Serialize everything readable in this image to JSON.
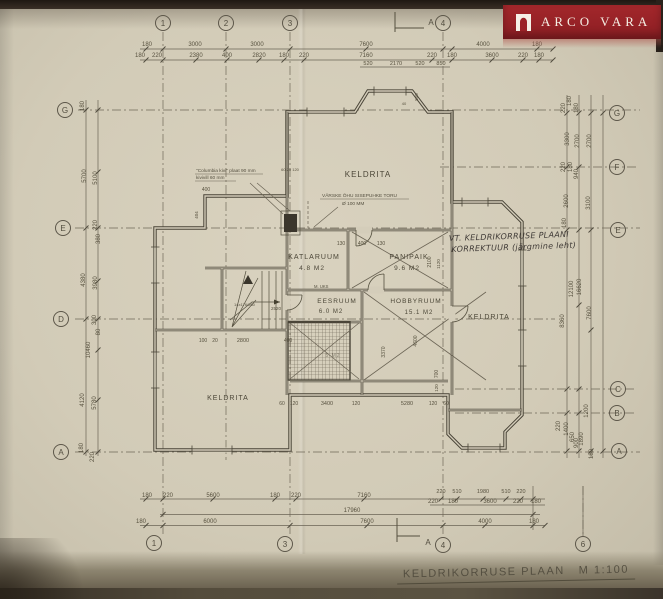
{
  "logo": {
    "brand": "ARCO VARA",
    "bg": "#9b2227"
  },
  "title": {
    "name": "KELDRIKORRUSE  PLAAN",
    "scale": "M 1:100"
  },
  "section_marker": "A",
  "grid": {
    "top": [
      "1",
      "2",
      "3",
      "4"
    ],
    "bottom": [
      "1",
      "3",
      "4",
      "6"
    ],
    "left": [
      "G",
      "E",
      "D",
      "A"
    ],
    "right": [
      "G",
      "F",
      "E",
      "C",
      "B",
      "A"
    ]
  },
  "rooms": {
    "keldrita_top": {
      "name": "KELDRITA"
    },
    "katlaruum": {
      "name": "KATLARUUM",
      "area": "4.8 M2"
    },
    "panipaik": {
      "name": "PANIPAIK",
      "area": "9.6 M2"
    },
    "eesruum": {
      "name": "EESRUUM",
      "area": "6.0 M2"
    },
    "hobbyruum": {
      "name": "HOBBYRUUM",
      "area": "15.1 M2"
    },
    "keldrita_right": {
      "name": "KELDRITA"
    },
    "keldrita_left": {
      "name": "KELDRITA"
    },
    "shaft": {
      "area": "5 M2"
    }
  },
  "notes": {
    "insulation_1": "\"Columbia kivi\" plaat 90 mm",
    "insulation_2": "kivivill 60 mm",
    "vent_1": "VÄRSKE ÕHU SISEPUHKE TORU",
    "vent_2": "Ø 100 MM",
    "door_label": "M. UKS",
    "stair_label": "14x176/260",
    "hand_1": "VT. KELDRIKORRUSE PLAANI",
    "hand_2": "KORREKTUUR (järgmine leht)"
  },
  "dim_labels": [
    {
      "x": 147,
      "y": 46,
      "t": "180"
    },
    {
      "x": 195,
      "y": 46,
      "t": "3000"
    },
    {
      "x": 257,
      "y": 46,
      "t": "3000"
    },
    {
      "x": 366,
      "y": 46,
      "t": "7600"
    },
    {
      "x": 483,
      "y": 46,
      "t": "4000"
    },
    {
      "x": 537,
      "y": 46,
      "t": "180"
    },
    {
      "x": 140,
      "y": 57,
      "t": "180"
    },
    {
      "x": 157,
      "y": 57,
      "t": "220"
    },
    {
      "x": 196,
      "y": 57,
      "t": "2380"
    },
    {
      "x": 227,
      "y": 57,
      "t": "400"
    },
    {
      "x": 259,
      "y": 57,
      "t": "2820"
    },
    {
      "x": 284,
      "y": 57,
      "t": "180"
    },
    {
      "x": 304,
      "y": 57,
      "t": "220"
    },
    {
      "x": 366,
      "y": 57,
      "t": "7160"
    },
    {
      "x": 432,
      "y": 57,
      "t": "220"
    },
    {
      "x": 452,
      "y": 57,
      "t": "180"
    },
    {
      "x": 492,
      "y": 57,
      "t": "3600"
    },
    {
      "x": 523,
      "y": 57,
      "t": "220"
    },
    {
      "x": 539,
      "y": 57,
      "t": "180"
    },
    {
      "x": 368,
      "y": 65,
      "t": "520",
      "s": 5.5
    },
    {
      "x": 396,
      "y": 65,
      "t": "2170",
      "s": 5.5
    },
    {
      "x": 420,
      "y": 65,
      "t": "520",
      "s": 5.5
    },
    {
      "x": 441,
      "y": 65,
      "t": "850",
      "s": 5.5
    },
    {
      "x": 147,
      "y": 497,
      "t": "180"
    },
    {
      "x": 168,
      "y": 497,
      "t": "220"
    },
    {
      "x": 213,
      "y": 497,
      "t": "5600"
    },
    {
      "x": 275,
      "y": 497,
      "t": "180"
    },
    {
      "x": 296,
      "y": 497,
      "t": "220"
    },
    {
      "x": 364,
      "y": 497,
      "t": "7160"
    },
    {
      "x": 441,
      "y": 493,
      "t": "220",
      "s": 5.5
    },
    {
      "x": 457,
      "y": 493,
      "t": "510",
      "s": 5.5
    },
    {
      "x": 483,
      "y": 493,
      "t": "1980",
      "s": 5.5
    },
    {
      "x": 506,
      "y": 493,
      "t": "510",
      "s": 5.5
    },
    {
      "x": 521,
      "y": 493,
      "t": "220",
      "s": 5.5
    },
    {
      "x": 433,
      "y": 503,
      "t": "220"
    },
    {
      "x": 453,
      "y": 503,
      "t": "180"
    },
    {
      "x": 490,
      "y": 503,
      "t": "3600"
    },
    {
      "x": 518,
      "y": 503,
      "t": "220"
    },
    {
      "x": 536,
      "y": 503,
      "t": "180"
    },
    {
      "x": 352,
      "y": 512,
      "t": "17960"
    },
    {
      "x": 141,
      "y": 523,
      "t": "180"
    },
    {
      "x": 210,
      "y": 523,
      "t": "6000"
    },
    {
      "x": 367,
      "y": 523,
      "t": "7600"
    },
    {
      "x": 485,
      "y": 523,
      "t": "4000"
    },
    {
      "x": 534,
      "y": 523,
      "t": "180"
    },
    {
      "x": 84,
      "y": 106,
      "t": "180",
      "r": -90
    },
    {
      "x": 86,
      "y": 176,
      "t": "5700",
      "r": -90
    },
    {
      "x": 97,
      "y": 178,
      "t": "5100",
      "r": -90
    },
    {
      "x": 97,
      "y": 225,
      "t": "220",
      "r": -90
    },
    {
      "x": 100,
      "y": 239,
      "t": "380",
      "r": -90
    },
    {
      "x": 85,
      "y": 280,
      "t": "4380",
      "r": -90
    },
    {
      "x": 97,
      "y": 283,
      "t": "3980",
      "r": -90
    },
    {
      "x": 96,
      "y": 320,
      "t": "300",
      "r": -90
    },
    {
      "x": 100,
      "y": 332,
      "t": "80",
      "r": -90
    },
    {
      "x": 90,
      "y": 350,
      "t": "10460",
      "r": -90
    },
    {
      "x": 84,
      "y": 400,
      "t": "4120",
      "r": -90
    },
    {
      "x": 96,
      "y": 403,
      "t": "5780",
      "r": -90
    },
    {
      "x": 83,
      "y": 448,
      "t": "180",
      "r": -90
    },
    {
      "x": 94,
      "y": 457,
      "t": "220",
      "r": -90
    },
    {
      "x": 571,
      "y": 101,
      "t": "180",
      "r": -90
    },
    {
      "x": 565,
      "y": 108,
      "t": "220",
      "r": -90
    },
    {
      "x": 578,
      "y": 108,
      "t": "180",
      "r": -90
    },
    {
      "x": 569,
      "y": 139,
      "t": "3300",
      "r": -90
    },
    {
      "x": 579,
      "y": 141,
      "t": "2700",
      "r": -90
    },
    {
      "x": 591,
      "y": 141,
      "t": "2700",
      "r": -90
    },
    {
      "x": 565,
      "y": 167,
      "t": "220",
      "r": -90
    },
    {
      "x": 572,
      "y": 167,
      "t": "180",
      "r": -90
    },
    {
      "x": 578,
      "y": 174,
      "t": "940",
      "r": -90
    },
    {
      "x": 568,
      "y": 201,
      "t": "2600",
      "r": -90
    },
    {
      "x": 590,
      "y": 203,
      "t": "3100",
      "r": -90
    },
    {
      "x": 566,
      "y": 223,
      "t": "180",
      "r": -90
    },
    {
      "x": 573,
      "y": 289,
      "t": "12100",
      "r": -90
    },
    {
      "x": 581,
      "y": 287,
      "t": "16620",
      "r": -90
    },
    {
      "x": 564,
      "y": 321,
      "t": "8360",
      "r": -90
    },
    {
      "x": 591,
      "y": 313,
      "t": "7600",
      "r": -90
    },
    {
      "x": 588,
      "y": 411,
      "t": "1200",
      "r": -90
    },
    {
      "x": 560,
      "y": 426,
      "t": "220",
      "r": -90
    },
    {
      "x": 568,
      "y": 429,
      "t": "1400",
      "r": -90
    },
    {
      "x": 574,
      "y": 437,
      "t": "650",
      "r": -90
    },
    {
      "x": 578,
      "y": 443,
      "t": "900",
      "r": -90
    },
    {
      "x": 583,
      "y": 439,
      "t": "1890",
      "r": -90
    },
    {
      "x": 593,
      "y": 454,
      "t": "180",
      "r": -90
    },
    {
      "x": 341,
      "y": 245,
      "t": "130",
      "s": 5
    },
    {
      "x": 362,
      "y": 245,
      "t": "400",
      "s": 5
    },
    {
      "x": 381,
      "y": 245,
      "t": "130",
      "s": 5
    },
    {
      "x": 203,
      "y": 342,
      "t": "100",
      "s": 5
    },
    {
      "x": 215,
      "y": 342,
      "t": "20",
      "s": 5
    },
    {
      "x": 243,
      "y": 342,
      "t": "2800",
      "s": 5.5
    },
    {
      "x": 288,
      "y": 342,
      "t": "400",
      "s": 5
    },
    {
      "x": 282,
      "y": 405,
      "t": "60",
      "s": 5
    },
    {
      "x": 294,
      "y": 405,
      "t": "120",
      "s": 5
    },
    {
      "x": 327,
      "y": 405,
      "t": "3400",
      "s": 5.5
    },
    {
      "x": 356,
      "y": 405,
      "t": "120",
      "s": 5
    },
    {
      "x": 407,
      "y": 405,
      "t": "5280",
      "s": 5.5
    },
    {
      "x": 433,
      "y": 405,
      "t": "120",
      "s": 5
    },
    {
      "x": 446,
      "y": 405,
      "t": "60",
      "s": 5
    },
    {
      "x": 385,
      "y": 352,
      "t": "3370",
      "r": -90,
      "s": 5
    },
    {
      "x": 417,
      "y": 341,
      "t": "4600",
      "r": -90,
      "s": 5
    },
    {
      "x": 438,
      "y": 374,
      "t": "700",
      "r": -90,
      "s": 5
    },
    {
      "x": 438,
      "y": 388,
      "t": "120",
      "r": -90,
      "s": 4.5
    },
    {
      "x": 431,
      "y": 262,
      "t": "2100",
      "r": -90,
      "s": 5
    },
    {
      "x": 440,
      "y": 264,
      "t": "1120",
      "r": -90,
      "s": 4.5
    },
    {
      "x": 276,
      "y": 310,
      "t": "2520",
      "s": 4.5
    },
    {
      "x": 206,
      "y": 191,
      "t": "400",
      "s": 5
    },
    {
      "x": 198,
      "y": 215,
      "t": "404",
      "r": -90,
      "s": 4.5
    },
    {
      "x": 290,
      "y": 171,
      "t": "60 20 120",
      "s": 4
    },
    {
      "x": 418,
      "y": 97,
      "t": "540",
      "r": -90,
      "s": 4.5
    },
    {
      "x": 404,
      "y": 105,
      "t": "40",
      "s": 4
    }
  ]
}
